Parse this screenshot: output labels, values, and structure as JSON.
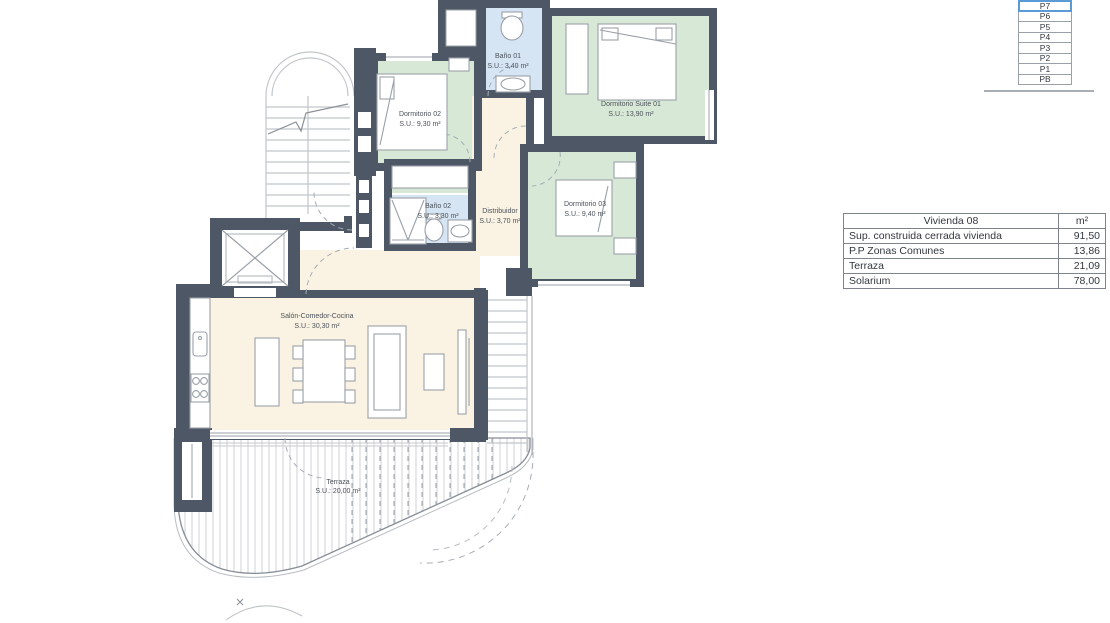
{
  "plan": {
    "rooms": [
      {
        "name": "Dormitorio 02",
        "area": "S.U.: 9,30 m²"
      },
      {
        "name": "Baño 01",
        "area": "S.U.: 3,40 m²"
      },
      {
        "name": "Dormitorio Suite 01",
        "area": "S.U.: 13,90 m²"
      },
      {
        "name": "Baño 02",
        "area": "S.U.: 3,30 m²"
      },
      {
        "name": "Distribuidor",
        "area": "S.U.: 3,70 m²"
      },
      {
        "name": "Dormitorio 03",
        "area": "S.U.: 9,40 m²"
      },
      {
        "name": "Salón-Comedor-Cocina",
        "area": "S.U.: 30,30 m²"
      },
      {
        "name": "Terraza",
        "area": "S.U.: 20,00 m²"
      }
    ]
  },
  "levels": {
    "items": [
      "P7",
      "P6",
      "P5",
      "P4",
      "P3",
      "P2",
      "P1",
      "PB"
    ],
    "selected": "P7"
  },
  "area_table": {
    "title": "Vivienda 08",
    "unit": "m²",
    "rows": [
      {
        "label": "Sup. construida cerrada vivienda",
        "value": "91,50"
      },
      {
        "label": "P.P Zonas Comunes",
        "value": "13,86"
      },
      {
        "label": "Terraza",
        "value": "21,09"
      },
      {
        "label": "Solarium",
        "value": "78,00"
      }
    ]
  },
  "colors": {
    "wall": "#4d5765",
    "bedroom_fill": "#d8e8d6",
    "bath_fill": "#d6e5f3",
    "living_fill": "#faf3e3",
    "selected_level": "#5b9bd5"
  }
}
